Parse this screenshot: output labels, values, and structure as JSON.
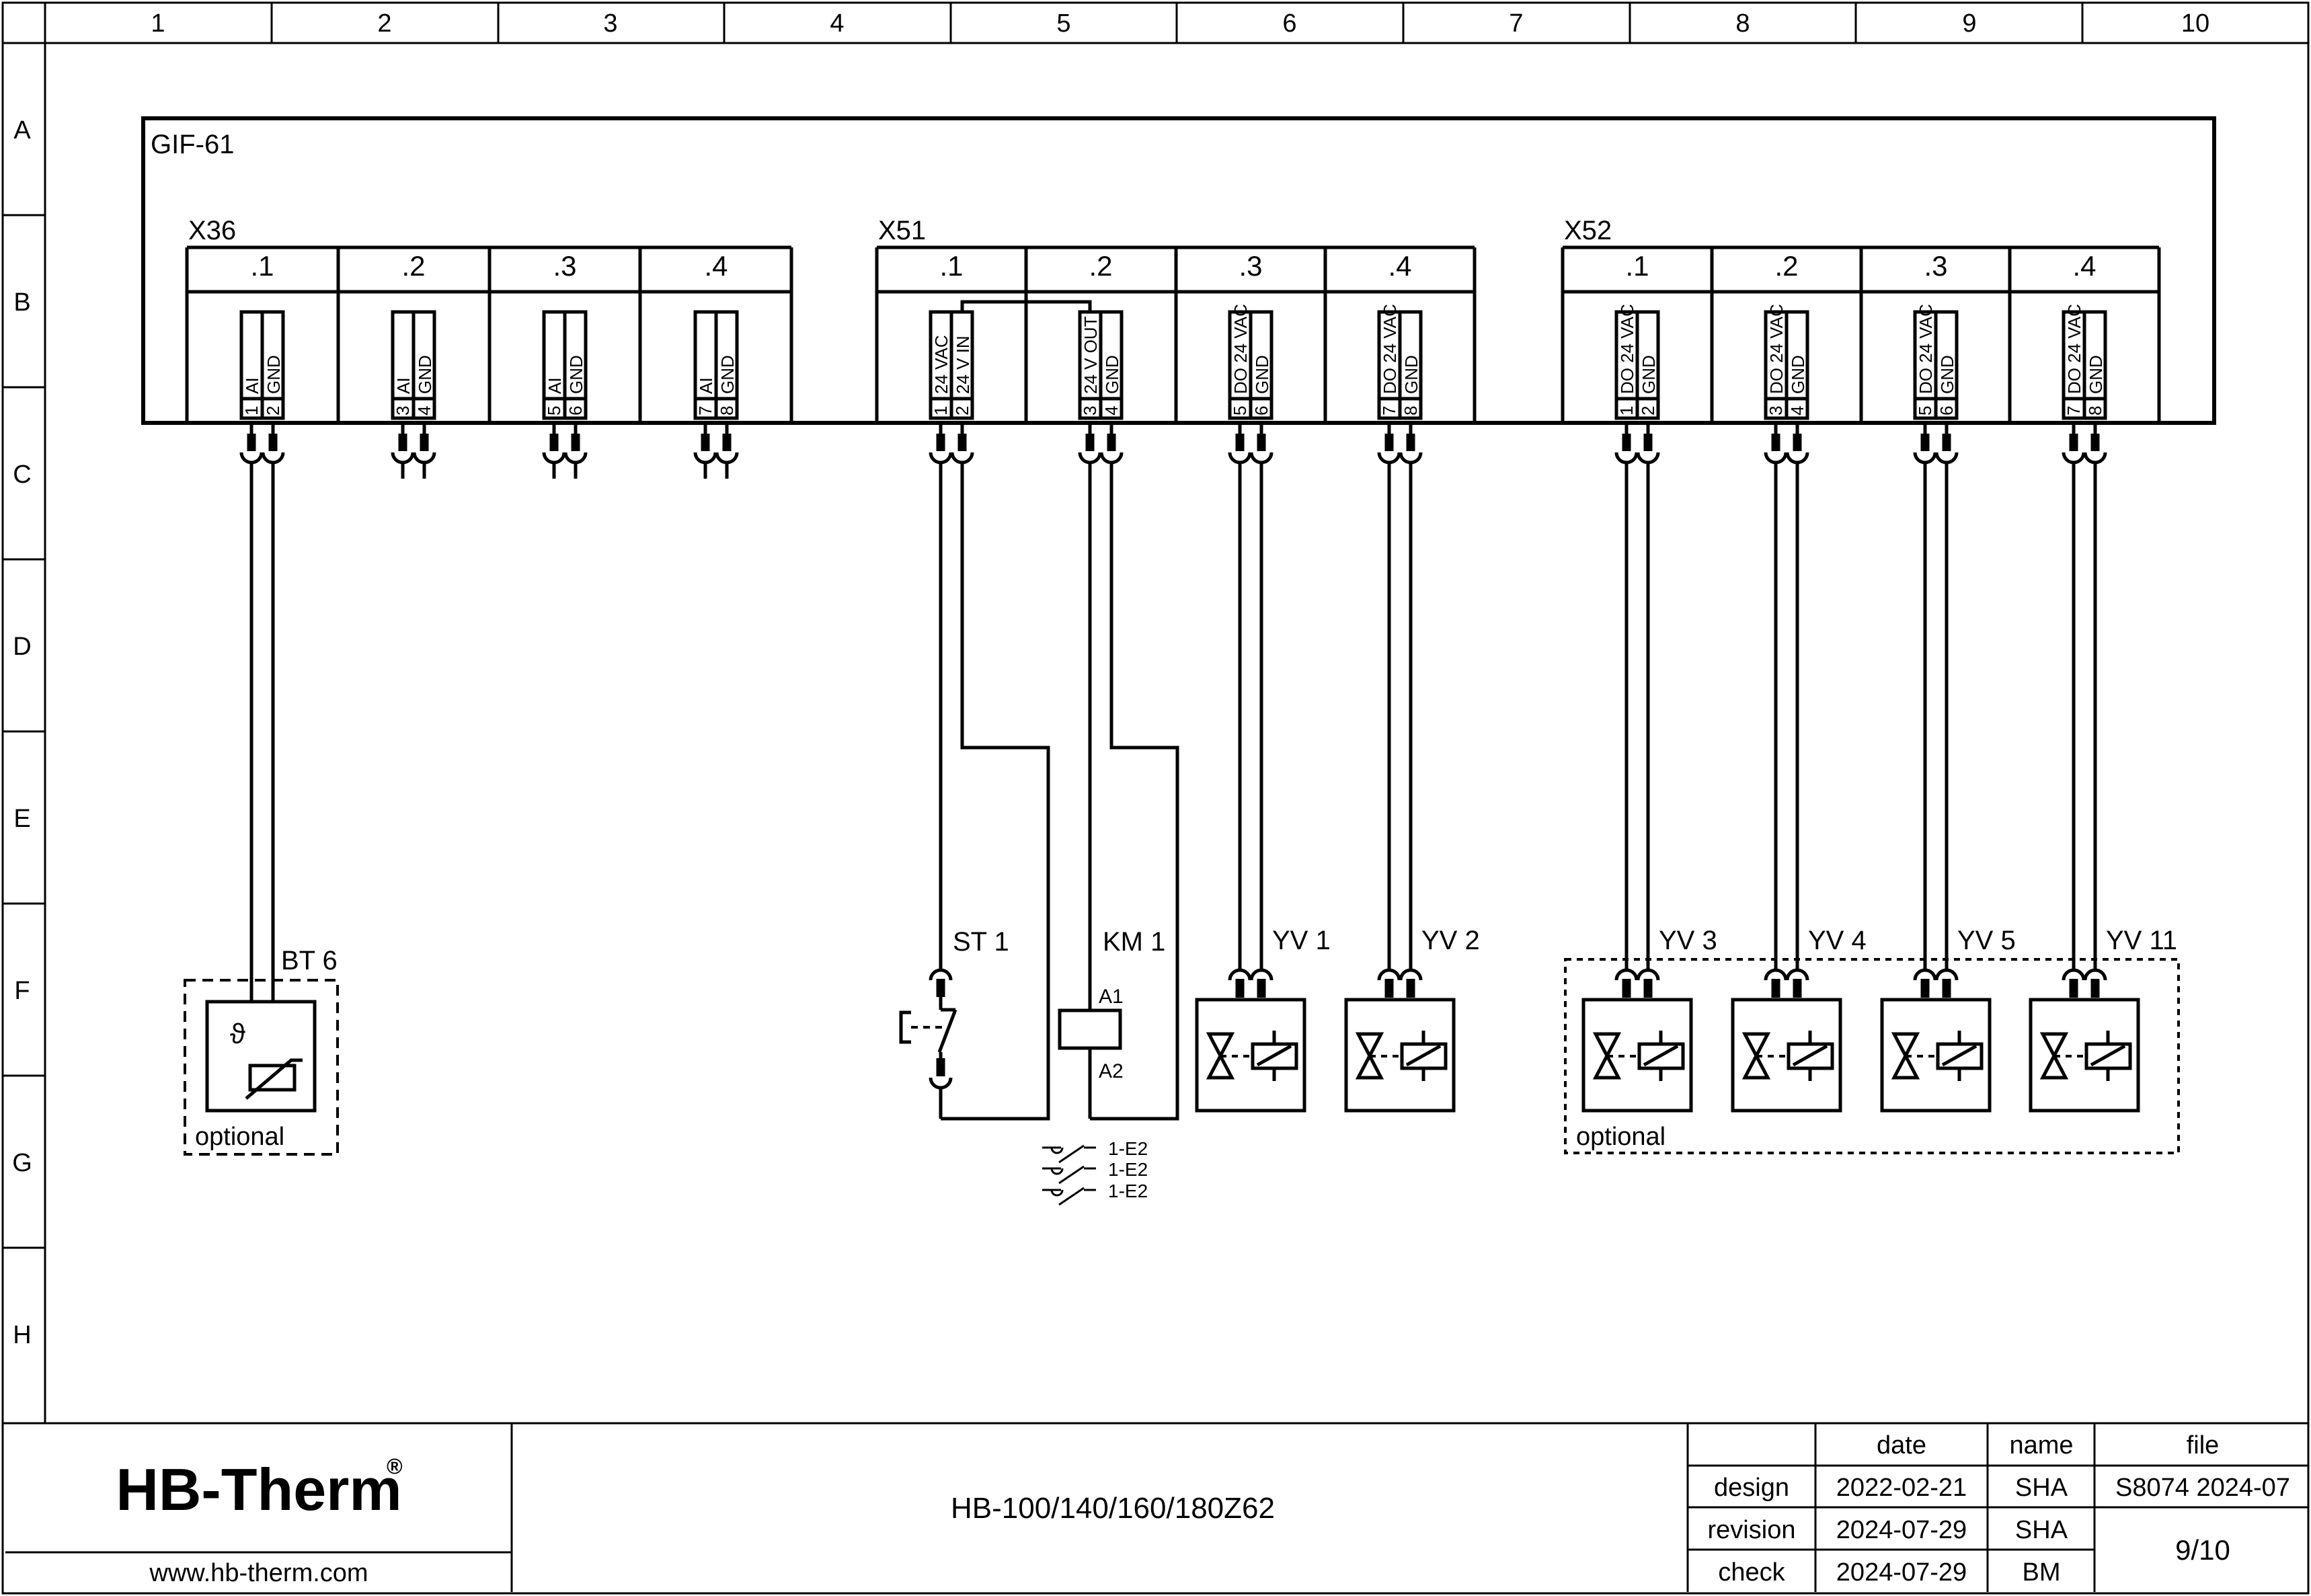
{
  "grid": {
    "columns": [
      "1",
      "2",
      "3",
      "4",
      "5",
      "6",
      "7",
      "8",
      "9",
      "10"
    ],
    "rows": [
      "A",
      "B",
      "C",
      "D",
      "E",
      "F",
      "G",
      "H"
    ]
  },
  "gif": {
    "label": "GIF-61"
  },
  "terminals": {
    "x36": {
      "label": "X36",
      "cells": [
        {
          "header": ".1",
          "pin1_no": "1",
          "pin1_label": "AI",
          "pin2_no": "2",
          "pin2_label": "GND"
        },
        {
          "header": ".2",
          "pin1_no": "3",
          "pin1_label": "AI",
          "pin2_no": "4",
          "pin2_label": "GND"
        },
        {
          "header": ".3",
          "pin1_no": "5",
          "pin1_label": "AI",
          "pin2_no": "6",
          "pin2_label": "GND"
        },
        {
          "header": ".4",
          "pin1_no": "7",
          "pin1_label": "AI",
          "pin2_no": "8",
          "pin2_label": "GND"
        }
      ]
    },
    "x51": {
      "label": "X51",
      "cells": [
        {
          "header": ".1",
          "pin1_no": "1",
          "pin1_label": "24 VAC",
          "pin2_no": "2",
          "pin2_label": "24 V IN"
        },
        {
          "header": ".2",
          "pin1_no": "3",
          "pin1_label": "24 V OUT",
          "pin2_no": "4",
          "pin2_label": "GND"
        },
        {
          "header": ".3",
          "pin1_no": "5",
          "pin1_label": "DO 24 VAC",
          "pin2_no": "6",
          "pin2_label": "GND"
        },
        {
          "header": ".4",
          "pin1_no": "7",
          "pin1_label": "DO 24 VAC",
          "pin2_no": "8",
          "pin2_label": "GND"
        }
      ]
    },
    "x52": {
      "label": "X52",
      "cells": [
        {
          "header": ".1",
          "pin1_no": "1",
          "pin1_label": "DO 24 VAC",
          "pin2_no": "2",
          "pin2_label": "GND"
        },
        {
          "header": ".2",
          "pin1_no": "3",
          "pin1_label": "DO 24 VAC",
          "pin2_no": "4",
          "pin2_label": "GND"
        },
        {
          "header": ".3",
          "pin1_no": "5",
          "pin1_label": "DO 24 VAC",
          "pin2_no": "6",
          "pin2_label": "GND"
        },
        {
          "header": ".4",
          "pin1_no": "7",
          "pin1_label": "DO 24 VAC",
          "pin2_no": "8",
          "pin2_label": "GND"
        }
      ]
    }
  },
  "components": {
    "bt6": {
      "label": "BT 6",
      "theta": "ϑ",
      "note": "optional"
    },
    "st1": {
      "label": "ST 1"
    },
    "km1": {
      "label": "KM 1",
      "a1": "A1",
      "a2": "A2"
    },
    "contacts": [
      "1-E2",
      "1-E2",
      "1-E2"
    ],
    "valves": [
      {
        "label": "YV 1"
      },
      {
        "label": "YV 2"
      },
      {
        "label": "YV 3"
      },
      {
        "label": "YV 4"
      },
      {
        "label": "YV 5"
      },
      {
        "label": "YV 11"
      }
    ],
    "optional_note": "optional"
  },
  "title_block": {
    "logo": "HB-Therm",
    "logo_reg": "®",
    "website": "www.hb-therm.com",
    "drawing_title": "HB-100/140/160/180Z62",
    "col_date": "date",
    "col_name": "name",
    "col_file": "file",
    "rows": [
      {
        "label": "design",
        "date": "2022-02-21",
        "name": "SHA"
      },
      {
        "label": "revision",
        "date": "2024-07-29",
        "name": "SHA"
      },
      {
        "label": "check",
        "date": "2024-07-29",
        "name": "BM"
      }
    ],
    "file_value": "S8074 2024-07",
    "page": "9/10"
  },
  "colors": {
    "ink": "#000000",
    "paper": "#ffffff",
    "logo_navy": "#1c2b4a"
  }
}
